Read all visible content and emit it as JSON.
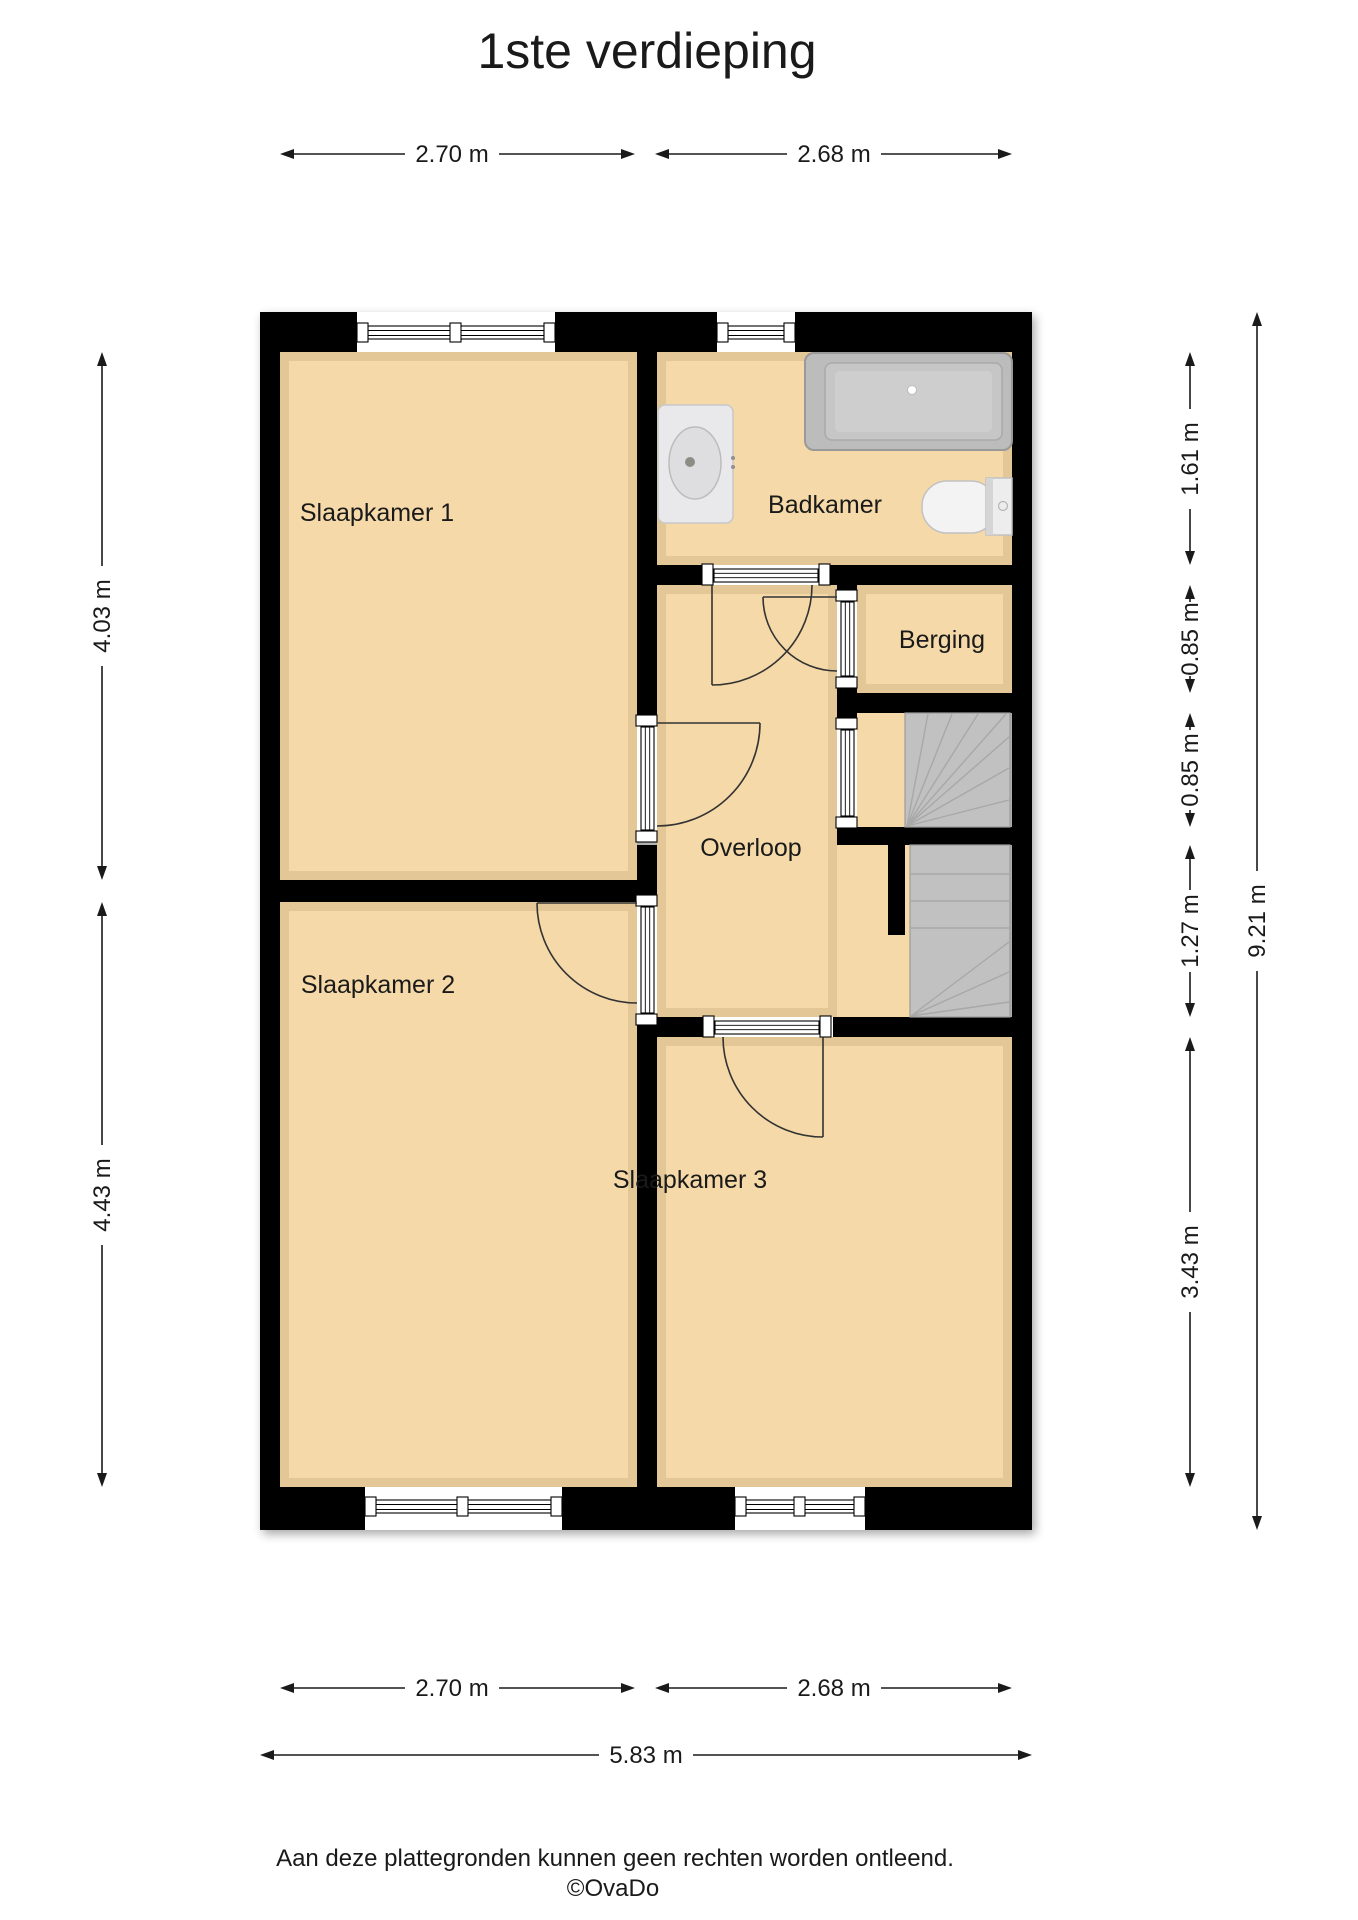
{
  "title": "1ste verdieping",
  "floorplan": {
    "rooms": [
      {
        "id": "slaapkamer-1",
        "label": "Slaapkamer 1"
      },
      {
        "id": "slaapkamer-2",
        "label": "Slaapkamer 2"
      },
      {
        "id": "slaapkamer-3",
        "label": "Slaapkamer 3"
      },
      {
        "id": "badkamer",
        "label": "Badkamer"
      },
      {
        "id": "berging",
        "label": "Berging"
      },
      {
        "id": "overloop",
        "label": "Overloop"
      }
    ],
    "fixtures": [
      "bathtub-icon",
      "sink-icon",
      "toilet-icon",
      "staircase-icon"
    ]
  },
  "dimensions": {
    "top": [
      {
        "label": "2.70 m"
      },
      {
        "label": "2.68 m"
      }
    ],
    "bottom": [
      {
        "label": "2.70 m"
      },
      {
        "label": "2.68 m"
      }
    ],
    "bottom_total": {
      "label": "5.83 m"
    },
    "left": [
      {
        "label": "4.03 m"
      },
      {
        "label": "4.43 m"
      }
    ],
    "right": [
      {
        "label": "1.61 m"
      },
      {
        "label": "0.85 m"
      },
      {
        "label": "0.85 m"
      },
      {
        "label": "1.27 m"
      },
      {
        "label": "3.43 m"
      }
    ],
    "right_total": {
      "label": "9.21 m"
    }
  },
  "footer": {
    "disclaimer": "Aan deze plattegronden kunnen geen rechten worden ontleend.",
    "credit": "©OvaDo"
  },
  "colors": {
    "floor": "#f5d9a8",
    "wall": "#000000",
    "stairs": "#c1c1c1",
    "text": "#1a1a1a",
    "background": "#ffffff"
  }
}
